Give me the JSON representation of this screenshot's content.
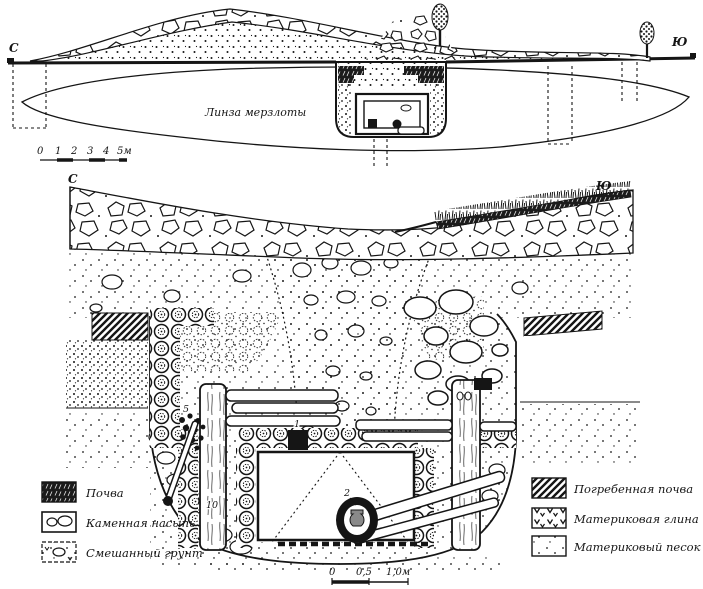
{
  "figure": {
    "title_semantic": "kurgan-excavation-sections",
    "profile": {
      "north_mark": "С",
      "south_mark": "Ю",
      "lens_label": "Линза мерзлоты",
      "scale": {
        "ticks": [
          "0",
          "1",
          "2",
          "3",
          "4",
          "5м"
        ]
      }
    },
    "section": {
      "north_mark": "С",
      "south_mark": "Ю",
      "scale": {
        "ticks": [
          "0",
          "0,5",
          "1,0м"
        ]
      },
      "find_labels": {
        "stone_box": "1",
        "vessel": "2",
        "organics": "5",
        "post": "10"
      }
    },
    "legend": {
      "left": [
        {
          "key": "soil",
          "label": "Почва"
        },
        {
          "key": "stone-mound",
          "label": "Каменная насыпь"
        },
        {
          "key": "mixed-ground",
          "label": "Смешанный грунт"
        }
      ],
      "right": [
        {
          "key": "buried-soil",
          "label": "Погребенная почва"
        },
        {
          "key": "virgin-clay",
          "label": "Материковая глина"
        },
        {
          "key": "virgin-sand",
          "label": "Материковый песок"
        }
      ]
    },
    "colors": {
      "ink": "#151515",
      "paper": "#ffffff"
    }
  }
}
